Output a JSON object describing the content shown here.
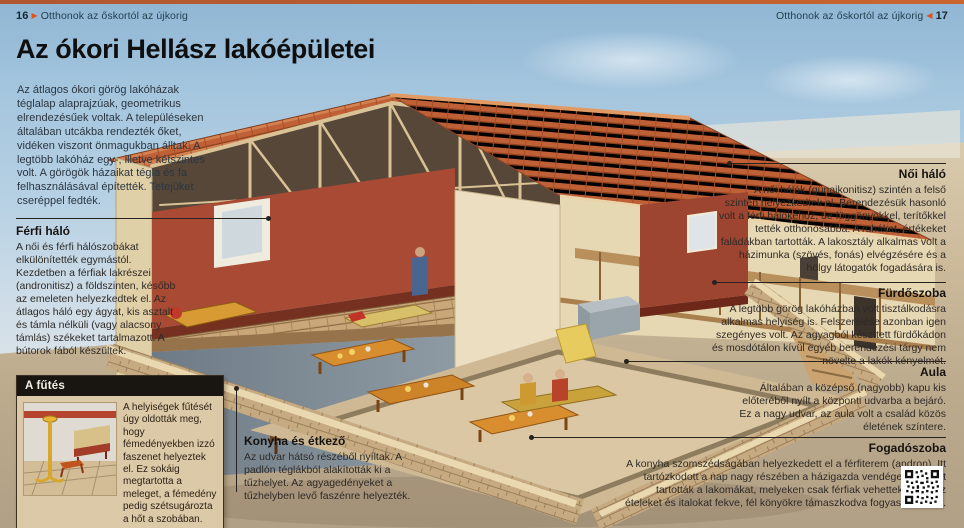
{
  "header": {
    "left": {
      "page": "16",
      "arrow": "▶",
      "title": "Otthonok az őskortól az újkorig"
    },
    "right": {
      "page": "17",
      "arrow": "◀",
      "title": "Otthonok az őskortól az újkorig"
    }
  },
  "article": {
    "title": "Az ókori Hellász lakóépületei",
    "intro": "Az átlagos ókori görög lakóházak téglalap alaprajzúak, geometrikus elrendezésűek voltak. A településeken általában utcákba rendezték őket, vidéken viszont önmagukban álltak. A legtöbb lakóház egy-, illetve kétszintes volt. A görögök házaikat tégla és fa felhasználásával építették. Tetejüket cseréppel fedték."
  },
  "annotations": {
    "ferfi_halo": {
      "heading": "Férfi háló",
      "body": "A női és férfi hálószobákat elkülönítették egymástól. Kezdetben a férfiak lakrészei (andronitisz) a földszinten, később az emeleten helyezkedtek el. Az átlagos háló egy ágyat, kis asztalt és támla nélküli (vagy alacsony támlás) székeket tartalmazott. A bútorok fából készültek."
    },
    "noi_halo": {
      "heading": "Női háló",
      "body": "A női hálók (günaikonitisz) szintén a felső szinten helyezkedtek el. Berendezésük hasonló volt a férfi hálókéhoz, de függönyökkel, terítőkkel tették otthonosabbá. A ruhákat, értékeket faládákban tartották. A lakosztály alkalmas volt a házimunka (szövés, fonás) elvégzésére és a hölgy látogatók fogadására is."
    },
    "furdoszoba": {
      "heading": "Fürdőszoba",
      "body": "A legtöbb görög lakóházban volt tisztálkodásra alkalmas helyiség is. Felszerelése azonban igen szegényes volt. Az agyagból készített fürdőkádon és mosdótálon kívül egyéb berendezési tárgy nem növelte a lakók kényelmét."
    },
    "aula": {
      "heading": "Aula",
      "body": "Általában a középső (nagyobb) kapu kis előteréből nyílt a központi udvarba a bejáró. Ez a nagy udvar, az aula volt a család közös életének színtere."
    },
    "fogadoszoba": {
      "heading": "Fogadószoba",
      "body": "A konyha szomszédságában helyezkedett el a férfiterem (andron). Itt tartózkodott a nap nagy részében a házigazda vendégeivel, és itt tartották a lakomákat, melyeken csak férfiak vehettek részt. Az ételeket és italokat fekve, fél könyökre támaszkodva fogyasztották el."
    },
    "konyha": {
      "heading": "Konyha és étkező",
      "body": "Az udvar hátsó részéből nyíltak. A padlón téglákból alakították ki a tűzhelyet. Az agyagedényeket a tűzhelyben levő faszénre helyezték."
    }
  },
  "sidebar_box": {
    "heading": "A fűtés",
    "body": "A helyiségek fűtését úgy oldották meg, hogy fémedényekben izzó faszenet helyeztek el. Ez sokáig megtartotta a meleget, a fémedény pedig szétsugározta a hőt a szobában."
  },
  "icons": {
    "qr": "qr-code",
    "arrow_right": "▶",
    "arrow_left": "◀"
  },
  "colors": {
    "accent_orange": "#e0531f",
    "roof_tile": "#c8693a",
    "interior_red": "#a84a34",
    "sky": "#a5c6de",
    "sand": "#c7b493",
    "box_bg": "#dcc9a8",
    "box_header": "#191511"
  }
}
